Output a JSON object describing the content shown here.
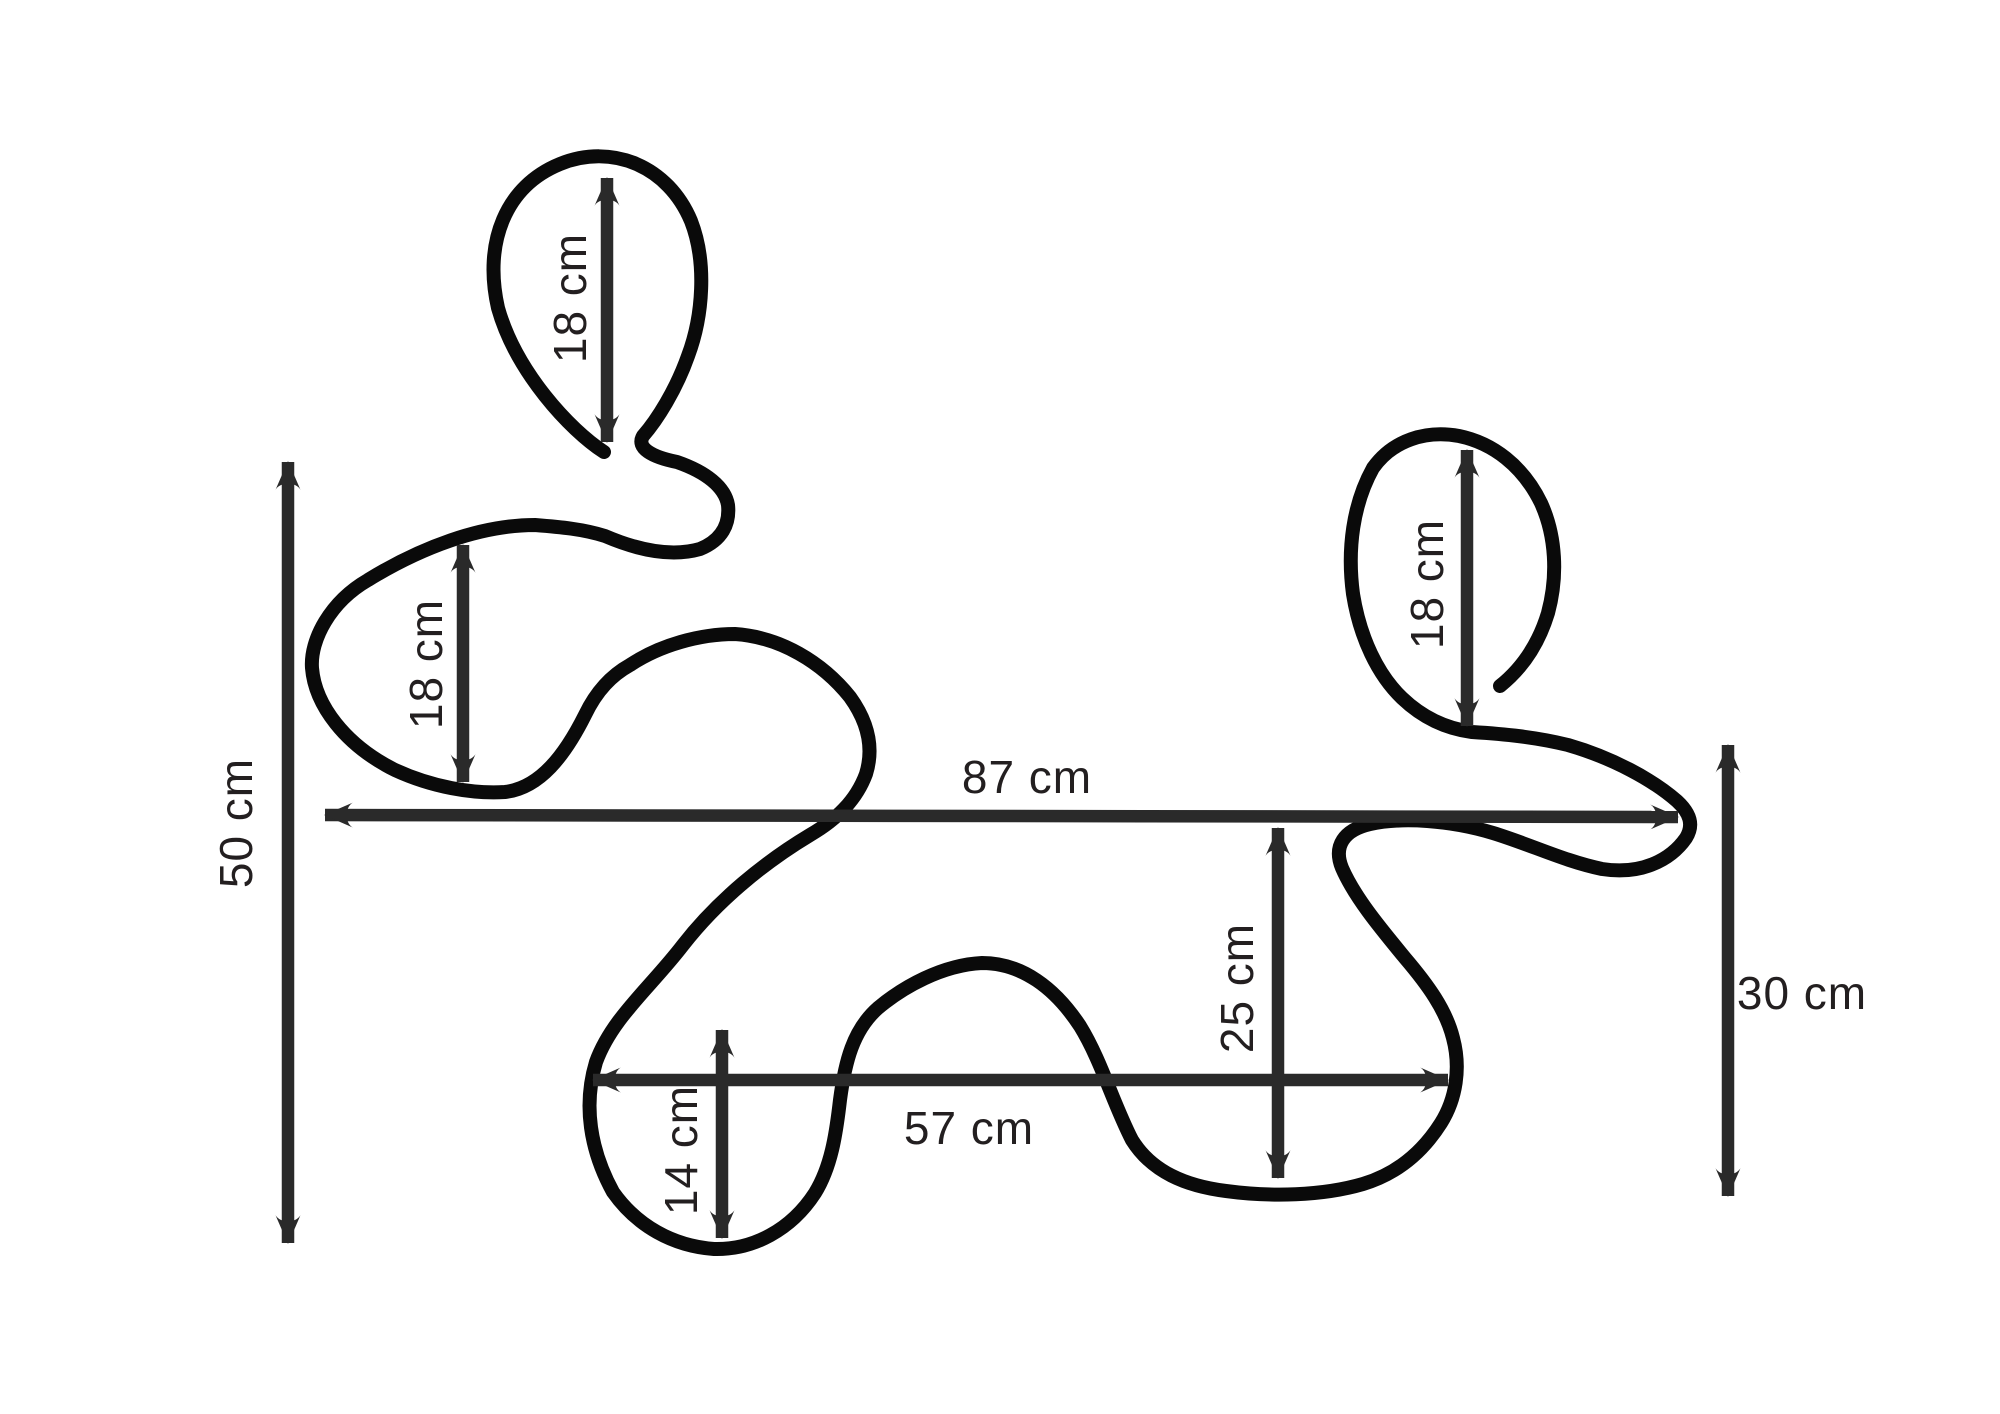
{
  "figure": {
    "type": "dimension-diagram",
    "background": "#ffffff",
    "outline_color": "#0a0a0a",
    "dimension_color": "#2a2a2a",
    "text_color": "#231f20",
    "unit": "cm"
  },
  "measurements": [
    {
      "id": "overall-height-left",
      "value": 50,
      "unit": "cm",
      "label": "50 cm",
      "orientation": "vertical",
      "label_rotated": true
    },
    {
      "id": "top-left-lobe-height",
      "value": 18,
      "unit": "cm",
      "label": "18 cm",
      "orientation": "vertical",
      "label_rotated": true
    },
    {
      "id": "left-lobe-height",
      "value": 18,
      "unit": "cm",
      "label": "18 cm",
      "orientation": "vertical",
      "label_rotated": true
    },
    {
      "id": "right-lobe-height",
      "value": 18,
      "unit": "cm",
      "label": "18 cm",
      "orientation": "vertical",
      "label_rotated": true
    },
    {
      "id": "overall-width",
      "value": 87,
      "unit": "cm",
      "label": "87 cm",
      "orientation": "horizontal",
      "label_rotated": false
    },
    {
      "id": "inner-right-height",
      "value": 25,
      "unit": "cm",
      "label": "25 cm",
      "orientation": "vertical",
      "label_rotated": true
    },
    {
      "id": "right-height",
      "value": 30,
      "unit": "cm",
      "label": "30 cm",
      "orientation": "vertical",
      "label_rotated": false
    },
    {
      "id": "lower-width",
      "value": 57,
      "unit": "cm",
      "label": "57 cm",
      "orientation": "horizontal",
      "label_rotated": false
    },
    {
      "id": "bottom-lobe-height",
      "value": 14,
      "unit": "cm",
      "label": "14 cm",
      "orientation": "vertical",
      "label_rotated": true
    }
  ]
}
